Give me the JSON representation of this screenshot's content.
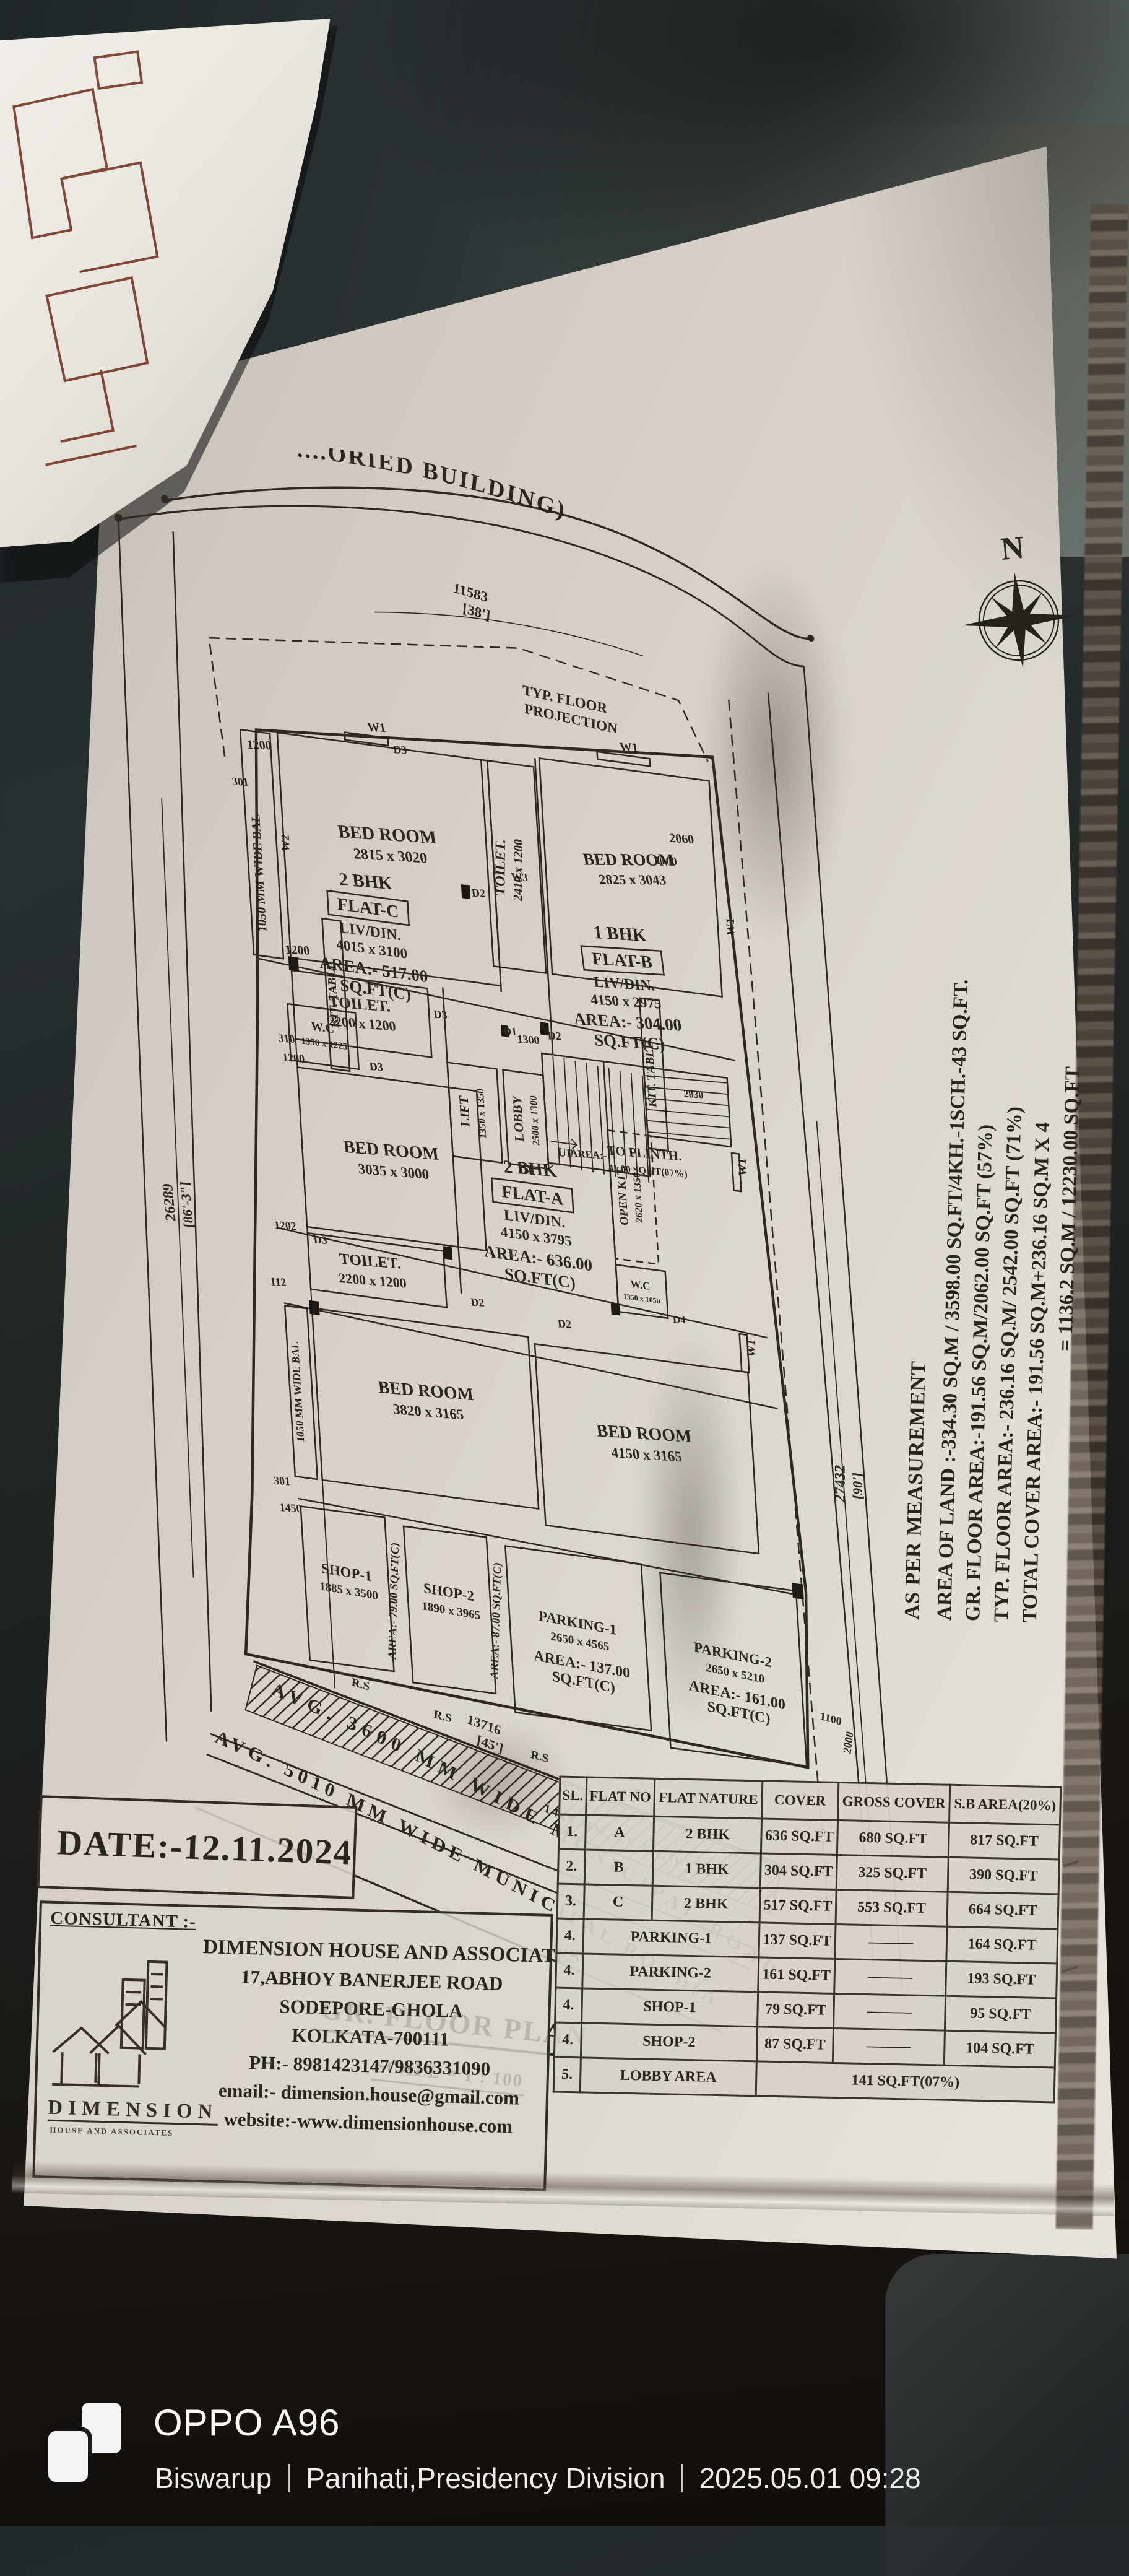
{
  "photo": {
    "device_label": "OPPO A96",
    "owner": "Biswarup",
    "location": "Panihati,Presidency Division",
    "datetime": "2025.05.01 09:28"
  },
  "sheet": {
    "title": "GR. FLOOR PLAN",
    "scale": "SCALE = 1 : 100",
    "date": "DATE:-12.11.2024",
    "consultant_label": "CONSULTANT :-",
    "logo_word": "DIMENSION",
    "logo_sub": "HOUSE AND ASSOCIATES",
    "firm_lines": [
      "DIMENSION HOUSE AND ASSOCIATES",
      "17,ABHOY BANERJEE ROAD",
      "SODEPORE-GHOLA",
      "KOLKATA-700111",
      "PH:- 8981423147/9836331090",
      "email:- dimension.house@gmail.com",
      "website:-www.dimensionhouse.com"
    ],
    "north": "N",
    "top_boundary_text": "....ORIED BUILDING)",
    "measurements": [
      "AS PER MEASUREMENT",
      "AREA OF LAND :-334.30 SQ.M / 3598.00 SQ.FT/4KH.-1SCH.-43 SQ.FT.",
      "GR. FLOOR AREA:-191.56 SQ.M/2062.00 SQ.FT (57%)",
      "TYP. FLOOR AREA:- 236.16 SQ.M/ 2542.00 SQ.FT (71%)",
      "TOTAL COVER AREA:- 191.56 SQ.M+236.16 SQ.M X 4",
      "= 1136.2 SQ.M / 12230.00 SQ.FT"
    ],
    "roads": {
      "road1": "AVG. 3600 MM WIDE MUNICIPAL ROAD",
      "road2": "AVG. 5010 MM WIDE MUNICIPAL ROAD(AFTER GIFT)",
      "gift": "1410 MM.U.L.B GIFT"
    }
  },
  "plan": {
    "labels": {
      "typ1": "TYP. FLOOR",
      "typ2": "PROJECTION",
      "bal": "1050 MM WIDE BAL",
      "bedroom1_name": "BED ROOM",
      "bedroom1_size": "2815 x 3020",
      "toilet_top_name": "TOILET.",
      "toilet_top_size": "2410 x 1200",
      "bedroom2_name": "BED ROOM",
      "bedroom2_size": "2825 x 3043",
      "toilet1_name": "TOILET.",
      "toilet1_size": "2200 x 1200",
      "flatc_type": "2 BHK",
      "flatc_name": "FLAT-C",
      "flatc_liv": "LIV/DIN.",
      "flatc_size": "4015 x 3100",
      "flatc_area": "AREA:- 517.00",
      "flatc_unit": "SQ.FT(C)",
      "flatb_type": "1 BHK",
      "flatb_name": "FLAT-B",
      "flatb_liv": "LIV/DIN.",
      "flatb_size": "4150 x 2975",
      "flatb_area": "AREA:- 304.00",
      "flatb_unit": "SQ.FT(C)",
      "kittable": "KIT. TABLE",
      "wc1_name": "W.C",
      "wc1_size": "1350 x 1225",
      "bedroom3_name": "BED ROOM",
      "bedroom3_size": "3035 x 3000",
      "toilet2_name": "TOILET.",
      "toilet2_size": "2200 x 1200",
      "lift1": "LIFT",
      "lift2": "1350 x 1350",
      "lobby1": "LOBBY",
      "lobby2": "2500 x 1300",
      "plinth0": "AREA:-",
      "plinth1": "TO PLINTH.",
      "plinth2": "41.00 SQ.FT(07%)",
      "flata_type": "2 BHK",
      "flata_name": "FLAT-A",
      "flata_liv": "LIV/DIN.",
      "flata_size": "4150 x 3795",
      "flata_area": "AREA:- 636.00",
      "flata_unit": "SQ.FT(C)",
      "openkit1": "OPEN KIT.",
      "openkit2": "2620 x 1350",
      "wc2_name": "W.C",
      "wc2_size": "1350 x 1050",
      "bedroom4_name": "BED ROOM",
      "bedroom4_size": "3820 x 3165",
      "bedroom5_name": "BED ROOM",
      "bedroom5_size": "4150 x 3165",
      "shop1_name": "SHOP-1",
      "shop1_size": "1885 x 3500",
      "shop1_area": "AREA:- 79.00 SQ.FT(C)",
      "shop2_name": "SHOP-2",
      "shop2_size": "1890 x 3965",
      "shop2_area": "AREA:- 87.00 SQ.FT(C)",
      "parking1_name": "PARKING-1",
      "parking1_size": "2650 x 4565",
      "parking1_area": "AREA:- 137.00",
      "parking1_unit": "SQ.FT(C)",
      "parking2_name": "PARKING-2",
      "parking2_size": "2650 x 5210",
      "parking2_area": "AREA:- 161.00",
      "parking2_unit": "SQ.FT(C)"
    },
    "dims": {
      "top1": "11583",
      "top2": "[38']",
      "bottom1": "13716",
      "bottom2": "[45']",
      "left1": "26289",
      "left2": "[86'-3\"]",
      "right1": "27432",
      "right2": "[90']",
      "a1200": "1200",
      "a301": "301",
      "a310": "310",
      "a1202": "1202",
      "a112": "112",
      "a1450": "1450",
      "a2060": "2060",
      "a1100": "1100",
      "a2000": "2000",
      "a1300": "1300",
      "a2830": "2830"
    },
    "tags": {
      "w1": "W1",
      "w2": "W2",
      "w3": "W3",
      "d1": "D1",
      "d2": "D2",
      "d3": "D3",
      "d4": "D4",
      "rs": "R.S",
      "up": "UP"
    }
  },
  "table": {
    "headers": [
      "SL.",
      "FLAT NO",
      "FLAT NATURE",
      "COVER",
      "GROSS COVER",
      "S.B AREA(20%)"
    ],
    "rows": [
      [
        "1.",
        "A",
        "2 BHK",
        "636 SQ.FT",
        "680 SQ.FT",
        "817 SQ.FT"
      ],
      [
        "2.",
        "B",
        "1 BHK",
        "304 SQ.FT",
        "325 SQ.FT",
        "390 SQ.FT"
      ],
      [
        "3.",
        "C",
        "2 BHK",
        "517 SQ.FT",
        "553 SQ.FT",
        "664 SQ.FT"
      ],
      [
        "4.",
        "PARKING-1",
        "137 SQ.FT",
        "———",
        "164 SQ.FT"
      ],
      [
        "4.",
        "PARKING-2",
        "161 SQ.FT",
        "———",
        "193 SQ.FT"
      ],
      [
        "4.",
        "SHOP-1",
        "79 SQ.FT",
        "———",
        "95 SQ.FT"
      ],
      [
        "4.",
        "SHOP-2",
        "87 SQ.FT",
        "———",
        "104 SQ.FT"
      ],
      [
        "5.",
        "LOBBY AREA",
        "141 SQ.FT(07%)"
      ]
    ]
  }
}
